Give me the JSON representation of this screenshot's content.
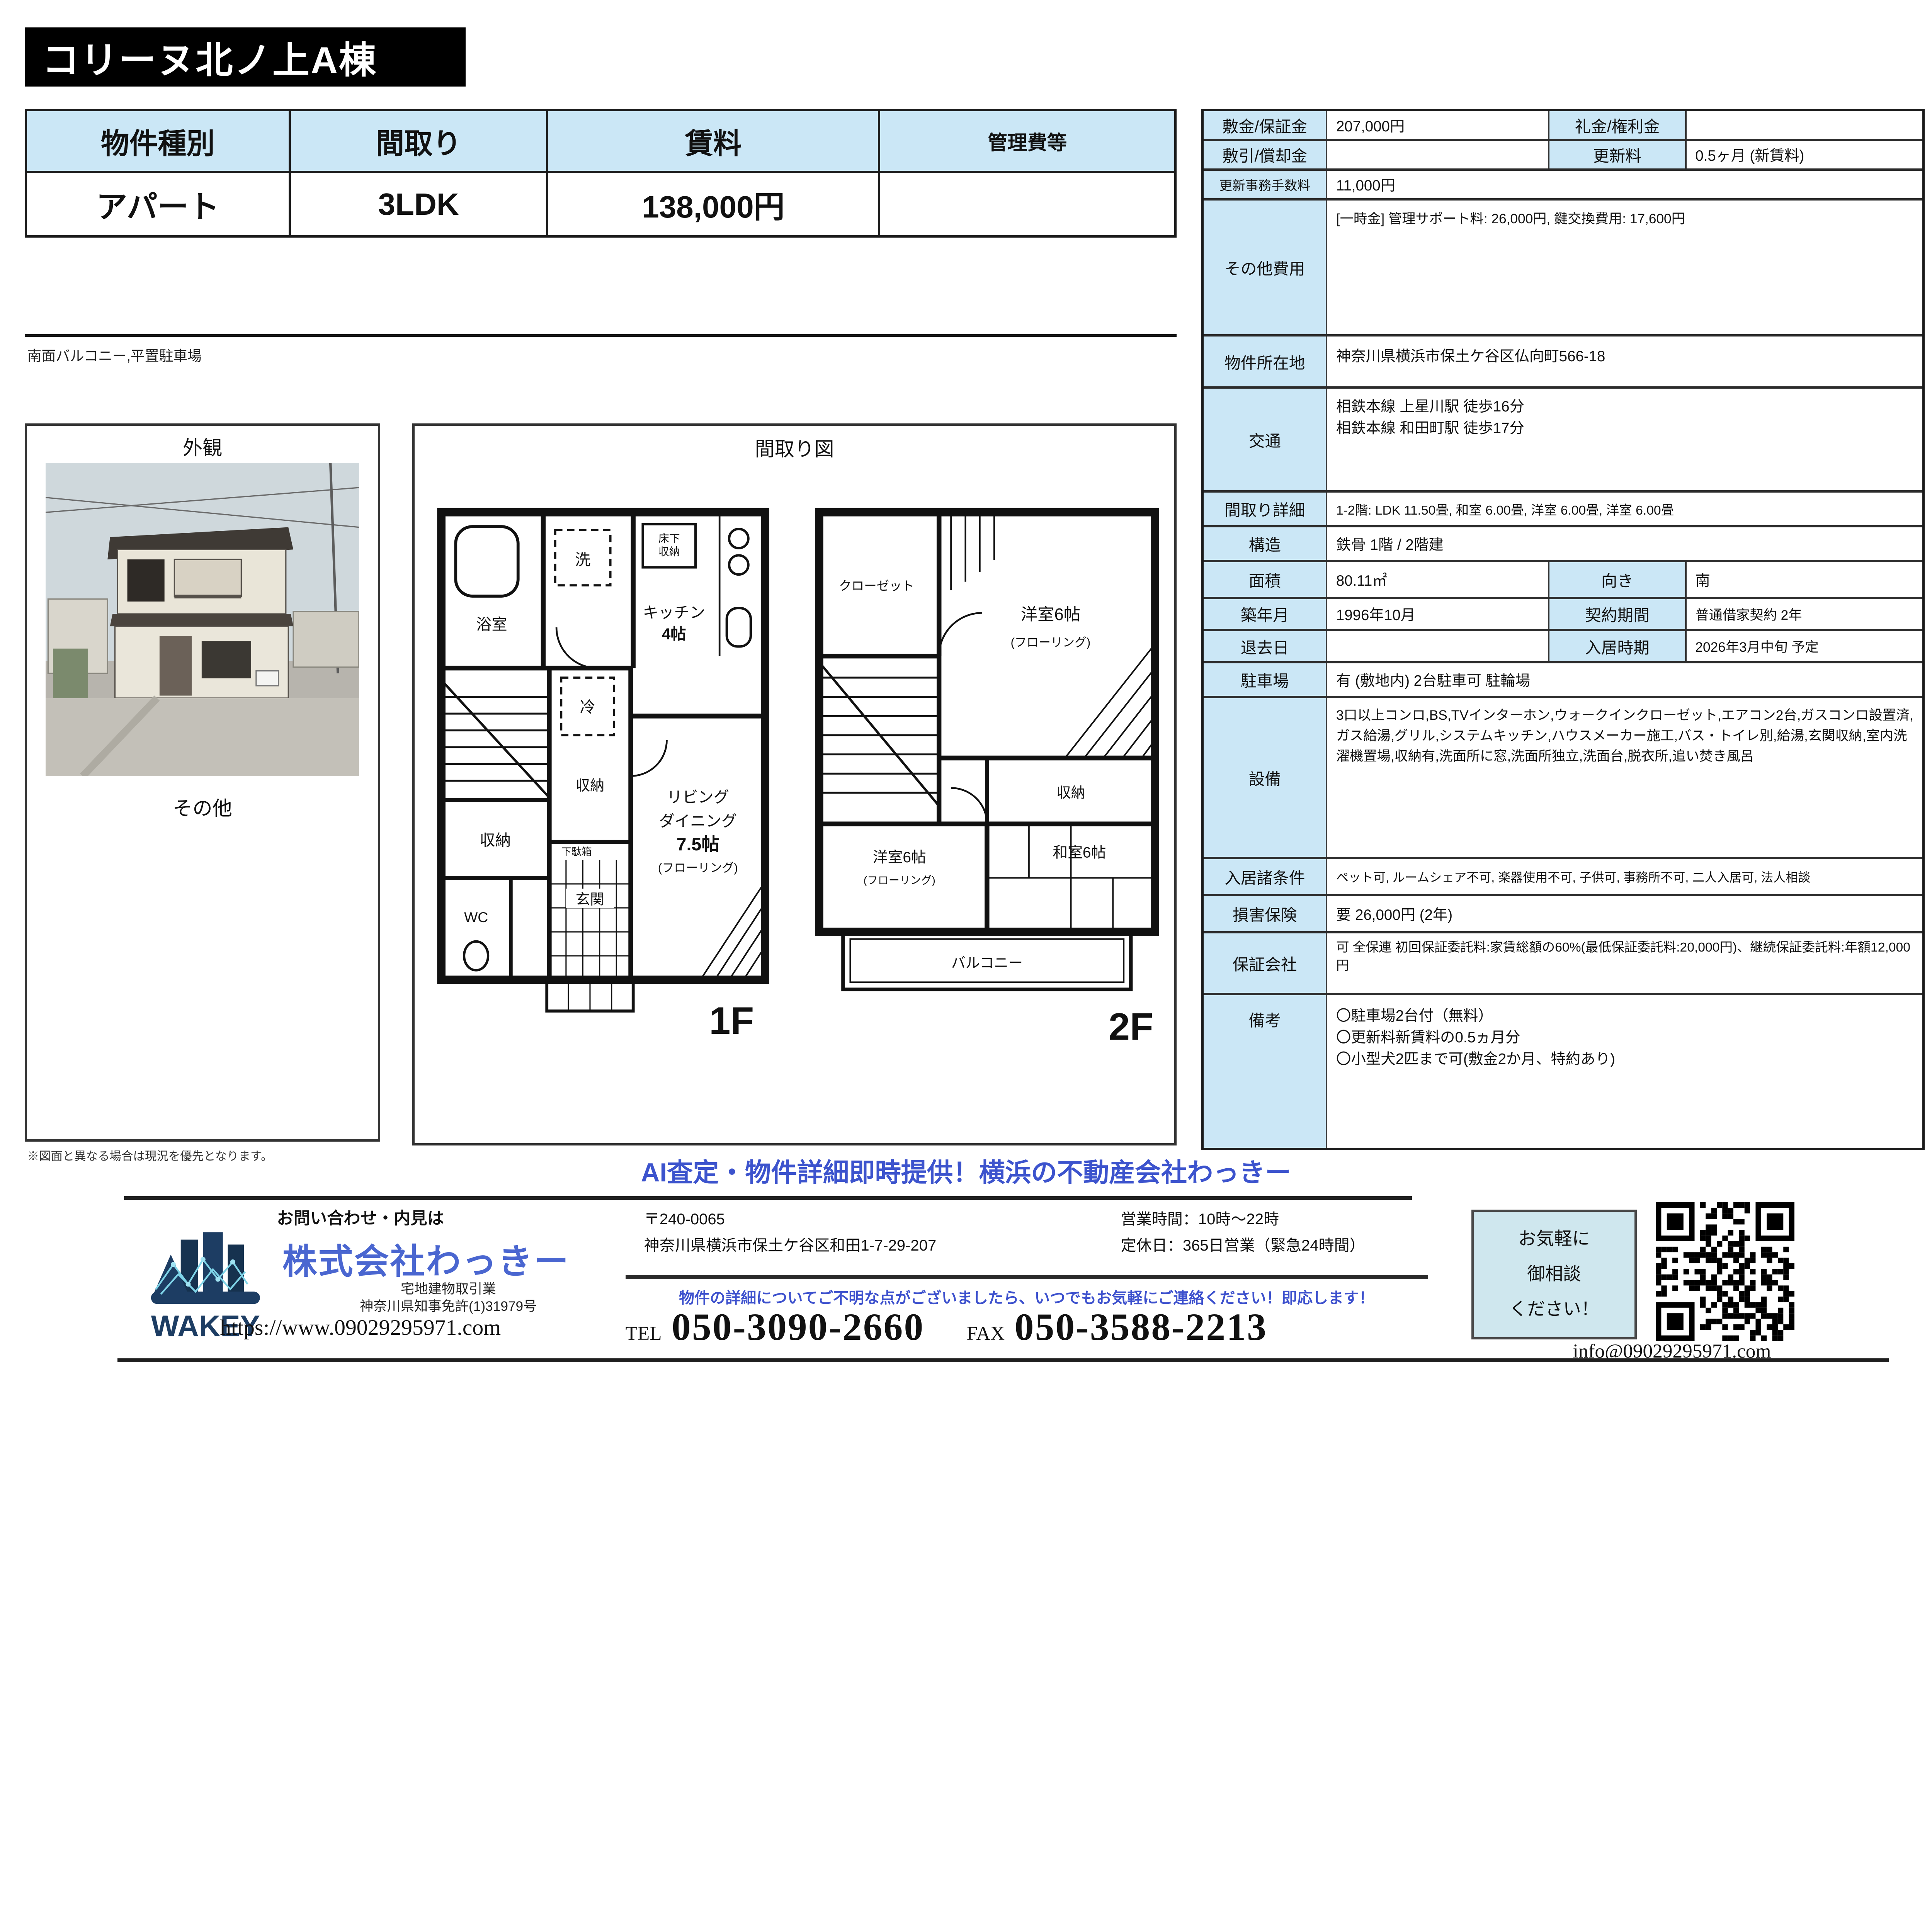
{
  "title": "コリーヌ北ノ上A棟",
  "summary_table": {
    "headers": [
      "物件種別",
      "間取り",
      "賃料",
      "管理費等"
    ],
    "values": [
      "アパート",
      "3LDK",
      "138,000円",
      ""
    ]
  },
  "note_left": "南面バルコニー,平置駐車場",
  "photo_section": {
    "exterior_label": "外観",
    "other_label": "その他",
    "disclaimer": "※図面と異なる場合は現況を優先となります。"
  },
  "floorplan": {
    "section_title": "間取り図",
    "f1": {
      "floor_label": "1F",
      "bath": "浴室",
      "laundry": "洗",
      "underfloor_1": "床下",
      "underfloor_2": "収納",
      "kitchen": "キッチン",
      "kitchen_size": "4帖",
      "fridge": "冷",
      "storage_a": "収納",
      "storage_b": "収納",
      "living_1": "リビング",
      "living_2": "ダイニング",
      "living_size": "7.5帖",
      "living_floor": "(フローリング)",
      "wc": "WC",
      "shoe_box": "下駄箱",
      "entrance": "玄関"
    },
    "f2": {
      "floor_label": "2F",
      "closet": "クローゼット",
      "western_a": "洋室6帖",
      "western_a_floor": "(フローリング)",
      "storage": "収納",
      "western_b": "洋室6帖",
      "western_b_floor": "(フローリング)",
      "japanese": "和室6帖",
      "balcony": "バルコニー"
    }
  },
  "details": {
    "r1": {
      "l1": "敷金/保証金",
      "v1": "207,000円",
      "l2": "礼金/権利金",
      "v2": ""
    },
    "r2": {
      "l1": "敷引/償却金",
      "v1": "",
      "l2": "更新料",
      "v2": "0.5ヶ月 (新賃料)"
    },
    "r3": {
      "l": "更新事務手数料",
      "v": "11,000円"
    },
    "r4": {
      "l": "その他費用",
      "v": "[一時金] 管理サポート料: 26,000円, 鍵交換費用: 17,600円"
    },
    "r5": {
      "l": "物件所在地",
      "v": "神奈川県横浜市保土ケ谷区仏向町566-18"
    },
    "r6": {
      "l": "交通",
      "v1": "相鉄本線 上星川駅 徒歩16分",
      "v2": "相鉄本線 和田町駅 徒歩17分"
    },
    "r7": {
      "l": "間取り詳細",
      "v": "1-2階: LDK 11.50畳, 和室 6.00畳, 洋室 6.00畳, 洋室 6.00畳"
    },
    "r8": {
      "l": "構造",
      "v": "鉄骨 1階 / 2階建"
    },
    "r9": {
      "l1": "面積",
      "v1": "80.11㎡",
      "l2": "向き",
      "v2": "南"
    },
    "r10": {
      "l1": "築年月",
      "v1": "1996年10月",
      "l2": "契約期間",
      "v2": "普通借家契約 2年"
    },
    "r11": {
      "l1": "退去日",
      "v1": "",
      "l2": "入居時期",
      "v2": "2026年3月中旬 予定"
    },
    "r12": {
      "l": "駐車場",
      "v": "有 (敷地内) 2台駐車可 駐輪場"
    },
    "r13": {
      "l": "設備",
      "v": "3口以上コンロ,BS,TVインターホン,ウォークインクローゼット,エアコン2台,ガスコンロ設置済,ガス給湯,グリル,システムキッチン,ハウスメーカー施工,バス・トイレ別,給湯,玄関収納,室内洗濯機置場,収納有,洗面所に窓,洗面所独立,洗面台,脱衣所,追い焚き風呂"
    },
    "r14": {
      "l": "入居諸条件",
      "v": "ペット可, ルームシェア不可, 楽器使用不可, 子供可, 事務所不可, 二人入居可, 法人相談"
    },
    "r15": {
      "l": "損害保険",
      "v": "要 26,000円 (2年)"
    },
    "r16": {
      "l": "保証会社",
      "v": "可 全保連 初回保証委託料:家賃総額の60%(最低保証委託料:20,000円)、継続保証委託料:年額12,000円"
    },
    "r17": {
      "l": "備考",
      "lines": [
        "〇駐車場2台付（無料）",
        "〇更新料新賃料の0.5ヵ月分",
        "〇小型犬2匹まで可(敷金2か月、特約あり)"
      ]
    }
  },
  "footer": {
    "headline": "AI査定・物件詳細即時提供！横浜の不動産会社わっきー",
    "contact_note": "お問い合わせ・内見は",
    "company": "株式会社わっきー",
    "logo_text": "WAKEY",
    "license1": "宅地建物取引業",
    "license2": "神奈川県知事免許(1)31979号",
    "url": "https://www.09029295971.com",
    "postal": "〒240-0065",
    "address": "神奈川県横浜市保土ケ谷区和田1-7-29-207",
    "hours": "営業時間：10時～22時",
    "holiday": "定休日：365日営業（緊急24時間）",
    "notice": "物件の詳細についてご不明な点がございましたら、いつでもお気軽にご連絡ください！即応します！",
    "tel_label": "TEL",
    "tel": "050-3090-2660",
    "fax_label": "FAX",
    "fax": "050-3588-2213",
    "consult": [
      "お気軽に",
      "御相談",
      "ください！"
    ],
    "email": "info@09029295971.com"
  },
  "colors": {
    "table_header_blue": "#cbe7f6",
    "headline_blue": "#3c53cd",
    "company_blue": "#4a66d0",
    "banner_black": "#000000",
    "consult_bg": "#cfe7ee"
  }
}
